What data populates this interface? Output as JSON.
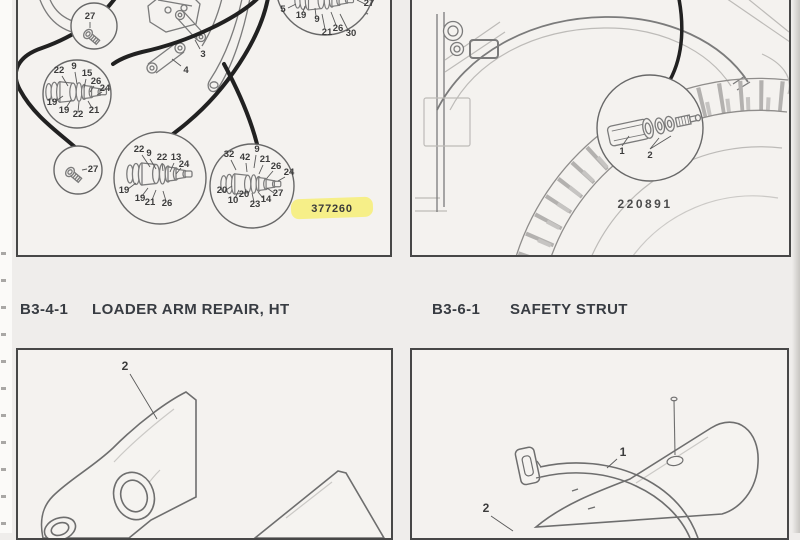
{
  "headings": {
    "left": {
      "code": "B3-4-1",
      "title": "LOADER ARM REPAIR, HT"
    },
    "right": {
      "code": "B3-6-1",
      "title": "SAFETY STRUT"
    }
  },
  "valve_panel": {
    "figure_number": "377260",
    "highlight_color": "#f6ee7c",
    "assembly_callouts": [
      "3",
      "4",
      "5"
    ],
    "detail_circles": {
      "top_bolt": [
        "27"
      ],
      "left_spool": [
        "22",
        "9",
        "15",
        "26",
        "24",
        "19",
        "19",
        "22",
        "21"
      ],
      "top_right_spool": [
        "19",
        "9",
        "21",
        "26",
        "30",
        "27"
      ],
      "mid_spool": [
        "22",
        "9",
        "22",
        "13",
        "24",
        "19",
        "19",
        "21",
        "26"
      ],
      "bottom_bolt": [
        "27"
      ],
      "right_spool": [
        "32",
        "42",
        "9",
        "21",
        "26",
        "24",
        "20",
        "10",
        "20",
        "23",
        "14",
        "27"
      ]
    }
  },
  "wheel_panel": {
    "figure_number": "220891",
    "inset_callouts": [
      "1",
      "2"
    ]
  },
  "loader_arm_panel": {
    "callouts": [
      "2"
    ]
  },
  "safety_strut_panel": {
    "callouts": [
      "1",
      "2"
    ]
  }
}
